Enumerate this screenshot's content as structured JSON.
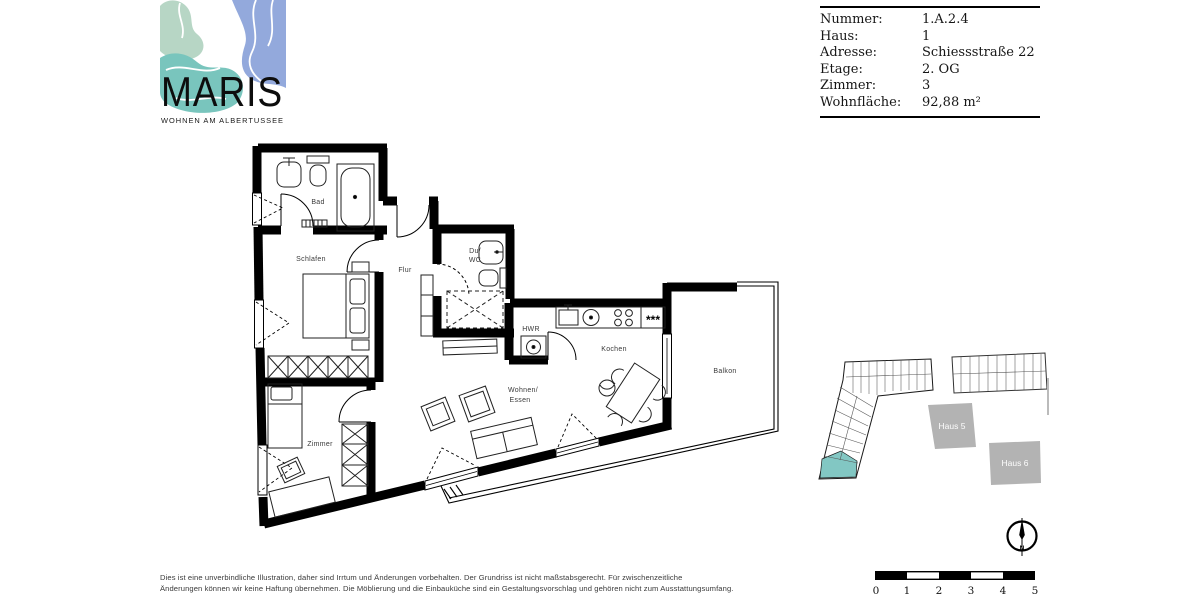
{
  "logo": {
    "title": "MARIS",
    "tagline": "WOHNEN AM ALBERTUSSEE",
    "colors": {
      "mint": "#b7d6c5",
      "teal": "#79c5bd",
      "blue": "#93a9dc"
    }
  },
  "info_table": {
    "rows": [
      {
        "label": "Nummer:",
        "value": "1.A.2.4"
      },
      {
        "label": "Haus:",
        "value": "1"
      },
      {
        "label": "Adresse:",
        "value": "Schiessstraße 22"
      },
      {
        "label": "Etage:",
        "value": "2. OG"
      },
      {
        "label": "Zimmer:",
        "value": "3"
      },
      {
        "label": "Wohnfläche:",
        "value": "92,88 m²"
      }
    ]
  },
  "floorplan": {
    "rooms": {
      "bad": "Bad",
      "schlafen": "Schlafen",
      "flur": "Flur",
      "duwc_line1": "Du/",
      "duwc_line2": "WC",
      "hwr": "HWR",
      "kochen": "Kochen",
      "wohnen_line1": "Wohnen/",
      "wohnen_line2": "Essen",
      "zimmer": "Zimmer",
      "balkon": "Balkon"
    },
    "fridge_symbol": "***"
  },
  "siteplan": {
    "haus5_label": "Haus 5",
    "haus6_label": "Haus 6",
    "highlight_color": "#82c7c3",
    "block_color": "#b3b3b3"
  },
  "compass": {
    "north": "N"
  },
  "scalebar": {
    "ticks": [
      "0",
      "1",
      "2",
      "3",
      "4",
      "5"
    ]
  },
  "disclaimer": {
    "line1": "Dies ist eine unverbindliche Illustration, daher sind Irrtum und Änderungen vorbehalten. Der Grundriss ist nicht maßstabsgerecht. Für zwischenzeitliche",
    "line2": "Änderungen können wir keine Haftung übernehmen. Die Möblierung und die Einbauküche sind ein Gestaltungsvorschlag und gehören nicht zum Ausstattungsumfang."
  }
}
